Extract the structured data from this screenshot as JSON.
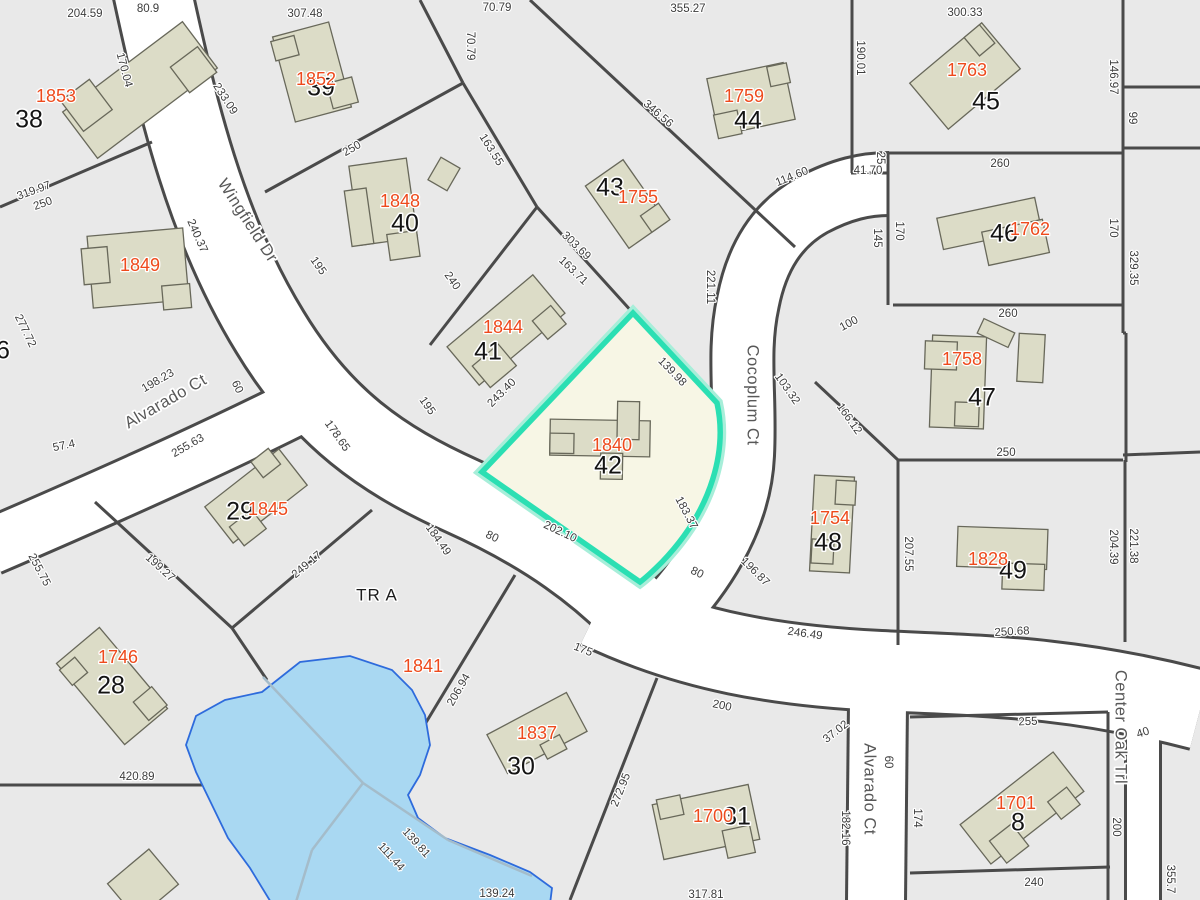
{
  "map": {
    "selected_parcel": {
      "lot": "42",
      "house_number": "1840"
    },
    "streets": [
      {
        "name": "Wingfield Dr",
        "x": 247,
        "y": 221,
        "r": 57
      },
      {
        "name": "Alvarado Ct",
        "x": 166,
        "y": 402,
        "r": -30
      },
      {
        "name": "Cocoplum Ct",
        "x": 752,
        "y": 395,
        "r": 90
      },
      {
        "name": "Alvarado Ct",
        "x": 869,
        "y": 789,
        "r": 90
      },
      {
        "name": "Center Oak Trl",
        "x": 1120,
        "y": 727,
        "r": 90
      }
    ],
    "tract": {
      "name": "TR A",
      "x": 377,
      "y": 596,
      "r": 0
    },
    "labels": {
      "lots": [
        {
          "n": "38",
          "x": 29,
          "y": 121
        },
        {
          "n": "39",
          "x": 321,
          "y": 89
        },
        {
          "n": "40",
          "x": 405,
          "y": 225
        },
        {
          "n": "41",
          "x": 488,
          "y": 353
        },
        {
          "n": "42",
          "x": 608,
          "y": 467
        },
        {
          "n": "43",
          "x": 610,
          "y": 189
        },
        {
          "n": "44",
          "x": 748,
          "y": 122
        },
        {
          "n": "45",
          "x": 986,
          "y": 103
        },
        {
          "n": "46",
          "x": 1004,
          "y": 235
        },
        {
          "n": "47",
          "x": 982,
          "y": 399
        },
        {
          "n": "48",
          "x": 828,
          "y": 544
        },
        {
          "n": "49",
          "x": 1013,
          "y": 572
        },
        {
          "n": "29",
          "x": 240,
          "y": 513
        },
        {
          "n": "28",
          "x": 111,
          "y": 687
        },
        {
          "n": "30",
          "x": 521,
          "y": 768
        },
        {
          "n": "31",
          "x": 737,
          "y": 818
        },
        {
          "n": "8",
          "x": 1018,
          "y": 824
        },
        {
          "n": "6",
          "x": 3,
          "y": 352
        }
      ],
      "houses": [
        {
          "n": "1853",
          "x": 56,
          "y": 97
        },
        {
          "n": "1852",
          "x": 316,
          "y": 80
        },
        {
          "n": "1849",
          "x": 140,
          "y": 266
        },
        {
          "n": "1848",
          "x": 400,
          "y": 202
        },
        {
          "n": "1844",
          "x": 503,
          "y": 328
        },
        {
          "n": "1755",
          "x": 638,
          "y": 198
        },
        {
          "n": "1759",
          "x": 744,
          "y": 97
        },
        {
          "n": "1763",
          "x": 967,
          "y": 71
        },
        {
          "n": "1762",
          "x": 1030,
          "y": 230
        },
        {
          "n": "1758",
          "x": 962,
          "y": 360
        },
        {
          "n": "1754",
          "x": 830,
          "y": 519
        },
        {
          "n": "1828",
          "x": 988,
          "y": 560
        },
        {
          "n": "1840",
          "x": 612,
          "y": 446
        },
        {
          "n": "1845",
          "x": 268,
          "y": 510
        },
        {
          "n": "1841",
          "x": 423,
          "y": 667
        },
        {
          "n": "1746",
          "x": 118,
          "y": 658
        },
        {
          "n": "1837",
          "x": 537,
          "y": 734
        },
        {
          "n": "1700",
          "x": 713,
          "y": 817
        },
        {
          "n": "1701",
          "x": 1016,
          "y": 804
        }
      ],
      "dims": [
        {
          "t": "204.59",
          "x": 85,
          "y": 14,
          "r": 0
        },
        {
          "t": "80.9",
          "x": 148,
          "y": 9,
          "r": 0
        },
        {
          "t": "307.48",
          "x": 305,
          "y": 14,
          "r": 0
        },
        {
          "t": "70.79",
          "x": 497,
          "y": 8,
          "r": 0
        },
        {
          "t": "355.27",
          "x": 688,
          "y": 9,
          "r": 0
        },
        {
          "t": "300.33",
          "x": 965,
          "y": 13,
          "r": 0
        },
        {
          "t": "170.04",
          "x": 124,
          "y": 70,
          "r": 75
        },
        {
          "t": "233.09",
          "x": 225,
          "y": 99,
          "r": 57
        },
        {
          "t": "70.79",
          "x": 470,
          "y": 46,
          "r": 90
        },
        {
          "t": "319.97",
          "x": 34,
          "y": 191,
          "r": -20
        },
        {
          "t": "250",
          "x": 43,
          "y": 204,
          "r": -20
        },
        {
          "t": "250",
          "x": 352,
          "y": 149,
          "r": -30
        },
        {
          "t": "163.55",
          "x": 491,
          "y": 150,
          "r": 58
        },
        {
          "t": "346.56",
          "x": 658,
          "y": 114,
          "r": 41
        },
        {
          "t": "190.01",
          "x": 860,
          "y": 58,
          "r": 90
        },
        {
          "t": "146.97",
          "x": 1113,
          "y": 77,
          "r": 90
        },
        {
          "t": "99",
          "x": 1132,
          "y": 118,
          "r": 90
        },
        {
          "t": "260",
          "x": 1000,
          "y": 164,
          "r": 0
        },
        {
          "t": "41.70",
          "x": 868,
          "y": 171,
          "r": 0
        },
        {
          "t": "25",
          "x": 880,
          "y": 158,
          "r": 90
        },
        {
          "t": "145",
          "x": 877,
          "y": 238,
          "r": 90
        },
        {
          "t": "170",
          "x": 899,
          "y": 231,
          "r": 90
        },
        {
          "t": "170",
          "x": 1113,
          "y": 228,
          "r": 90
        },
        {
          "t": "329.35",
          "x": 1133,
          "y": 268,
          "r": 90
        },
        {
          "t": "114.60",
          "x": 792,
          "y": 177,
          "r": -22
        },
        {
          "t": "221.11",
          "x": 710,
          "y": 287,
          "r": 90
        },
        {
          "t": "303.69",
          "x": 576,
          "y": 246,
          "r": 44
        },
        {
          "t": "163.71",
          "x": 573,
          "y": 271,
          "r": 44
        },
        {
          "t": "240",
          "x": 452,
          "y": 281,
          "r": 55
        },
        {
          "t": "240.37",
          "x": 197,
          "y": 236,
          "r": 66
        },
        {
          "t": "195",
          "x": 318,
          "y": 266,
          "r": 55
        },
        {
          "t": "195",
          "x": 427,
          "y": 406,
          "r": 55
        },
        {
          "t": "277.72",
          "x": 25,
          "y": 331,
          "r": 64
        },
        {
          "t": "198.23",
          "x": 158,
          "y": 381,
          "r": -30
        },
        {
          "t": "57.4",
          "x": 64,
          "y": 446,
          "r": -12
        },
        {
          "t": "255.63",
          "x": 188,
          "y": 446,
          "r": -30
        },
        {
          "t": "60",
          "x": 237,
          "y": 387,
          "r": 65
        },
        {
          "t": "178.65",
          "x": 337,
          "y": 436,
          "r": 55
        },
        {
          "t": "255.75",
          "x": 39,
          "y": 570,
          "r": 62
        },
        {
          "t": "199.27",
          "x": 160,
          "y": 568,
          "r": 42
        },
        {
          "t": "249.17",
          "x": 307,
          "y": 565,
          "r": -40
        },
        {
          "t": "243.40",
          "x": 502,
          "y": 393,
          "r": -45
        },
        {
          "t": "139.98",
          "x": 672,
          "y": 372,
          "r": 46
        },
        {
          "t": "202.10",
          "x": 560,
          "y": 532,
          "r": 25
        },
        {
          "t": "183.37",
          "x": 686,
          "y": 513,
          "r": 62
        },
        {
          "t": "184.49",
          "x": 438,
          "y": 540,
          "r": 55
        },
        {
          "t": "103.32",
          "x": 787,
          "y": 389,
          "r": 55
        },
        {
          "t": "196.87",
          "x": 755,
          "y": 572,
          "r": 45
        },
        {
          "t": "80",
          "x": 492,
          "y": 537,
          "r": 25
        },
        {
          "t": "80",
          "x": 697,
          "y": 573,
          "r": 25
        },
        {
          "t": "166.12",
          "x": 849,
          "y": 419,
          "r": 55
        },
        {
          "t": "100",
          "x": 849,
          "y": 324,
          "r": -28
        },
        {
          "t": "207.55",
          "x": 908,
          "y": 554,
          "r": 90
        },
        {
          "t": "250",
          "x": 1006,
          "y": 453,
          "r": 0
        },
        {
          "t": "260",
          "x": 1008,
          "y": 314,
          "r": 0
        },
        {
          "t": "204.39",
          "x": 1113,
          "y": 547,
          "r": 90
        },
        {
          "t": "221.38",
          "x": 1133,
          "y": 546,
          "r": 90
        },
        {
          "t": "246.49",
          "x": 805,
          "y": 634,
          "r": 8
        },
        {
          "t": "250.68",
          "x": 1012,
          "y": 632,
          "r": -3
        },
        {
          "t": "420.89",
          "x": 137,
          "y": 777,
          "r": 0
        },
        {
          "t": "206.94",
          "x": 459,
          "y": 690,
          "r": -60
        },
        {
          "t": "175",
          "x": 583,
          "y": 650,
          "r": 22
        },
        {
          "t": "200",
          "x": 722,
          "y": 706,
          "r": 12
        },
        {
          "t": "272.95",
          "x": 621,
          "y": 790,
          "r": -68
        },
        {
          "t": "139.81",
          "x": 416,
          "y": 843,
          "r": 48
        },
        {
          "t": "111.44",
          "x": 391,
          "y": 857,
          "r": 48
        },
        {
          "t": "139.24",
          "x": 497,
          "y": 894,
          "r": 0
        },
        {
          "t": "317.81",
          "x": 706,
          "y": 895,
          "r": 0
        },
        {
          "t": "37.02",
          "x": 836,
          "y": 732,
          "r": -38
        },
        {
          "t": "60",
          "x": 888,
          "y": 762,
          "r": 90
        },
        {
          "t": "255",
          "x": 1028,
          "y": 722,
          "r": -2
        },
        {
          "t": "40",
          "x": 1143,
          "y": 733,
          "r": -18
        },
        {
          "t": "174",
          "x": 917,
          "y": 818,
          "r": 90
        },
        {
          "t": "182.16",
          "x": 845,
          "y": 828,
          "r": 90
        },
        {
          "t": "200",
          "x": 1116,
          "y": 827,
          "r": 90
        },
        {
          "t": "240",
          "x": 1034,
          "y": 883,
          "r": 0
        },
        {
          "t": "355.7",
          "x": 1170,
          "y": 879,
          "r": 90
        }
      ]
    },
    "colors": {
      "background": "#e9e9e9",
      "road": "#ffffff",
      "line": "#4a4a4a",
      "building_fill": "#dcdcc7",
      "building_stroke": "#68685a",
      "water_fill": "#a9d8f2",
      "water_stroke": "#2e6bdc",
      "water_line": "#a4bcca",
      "highlight_fill": "#f7f6e5",
      "highlight_stroke": "#2bdfb3",
      "highlight_glow": "#a7eed9"
    }
  }
}
